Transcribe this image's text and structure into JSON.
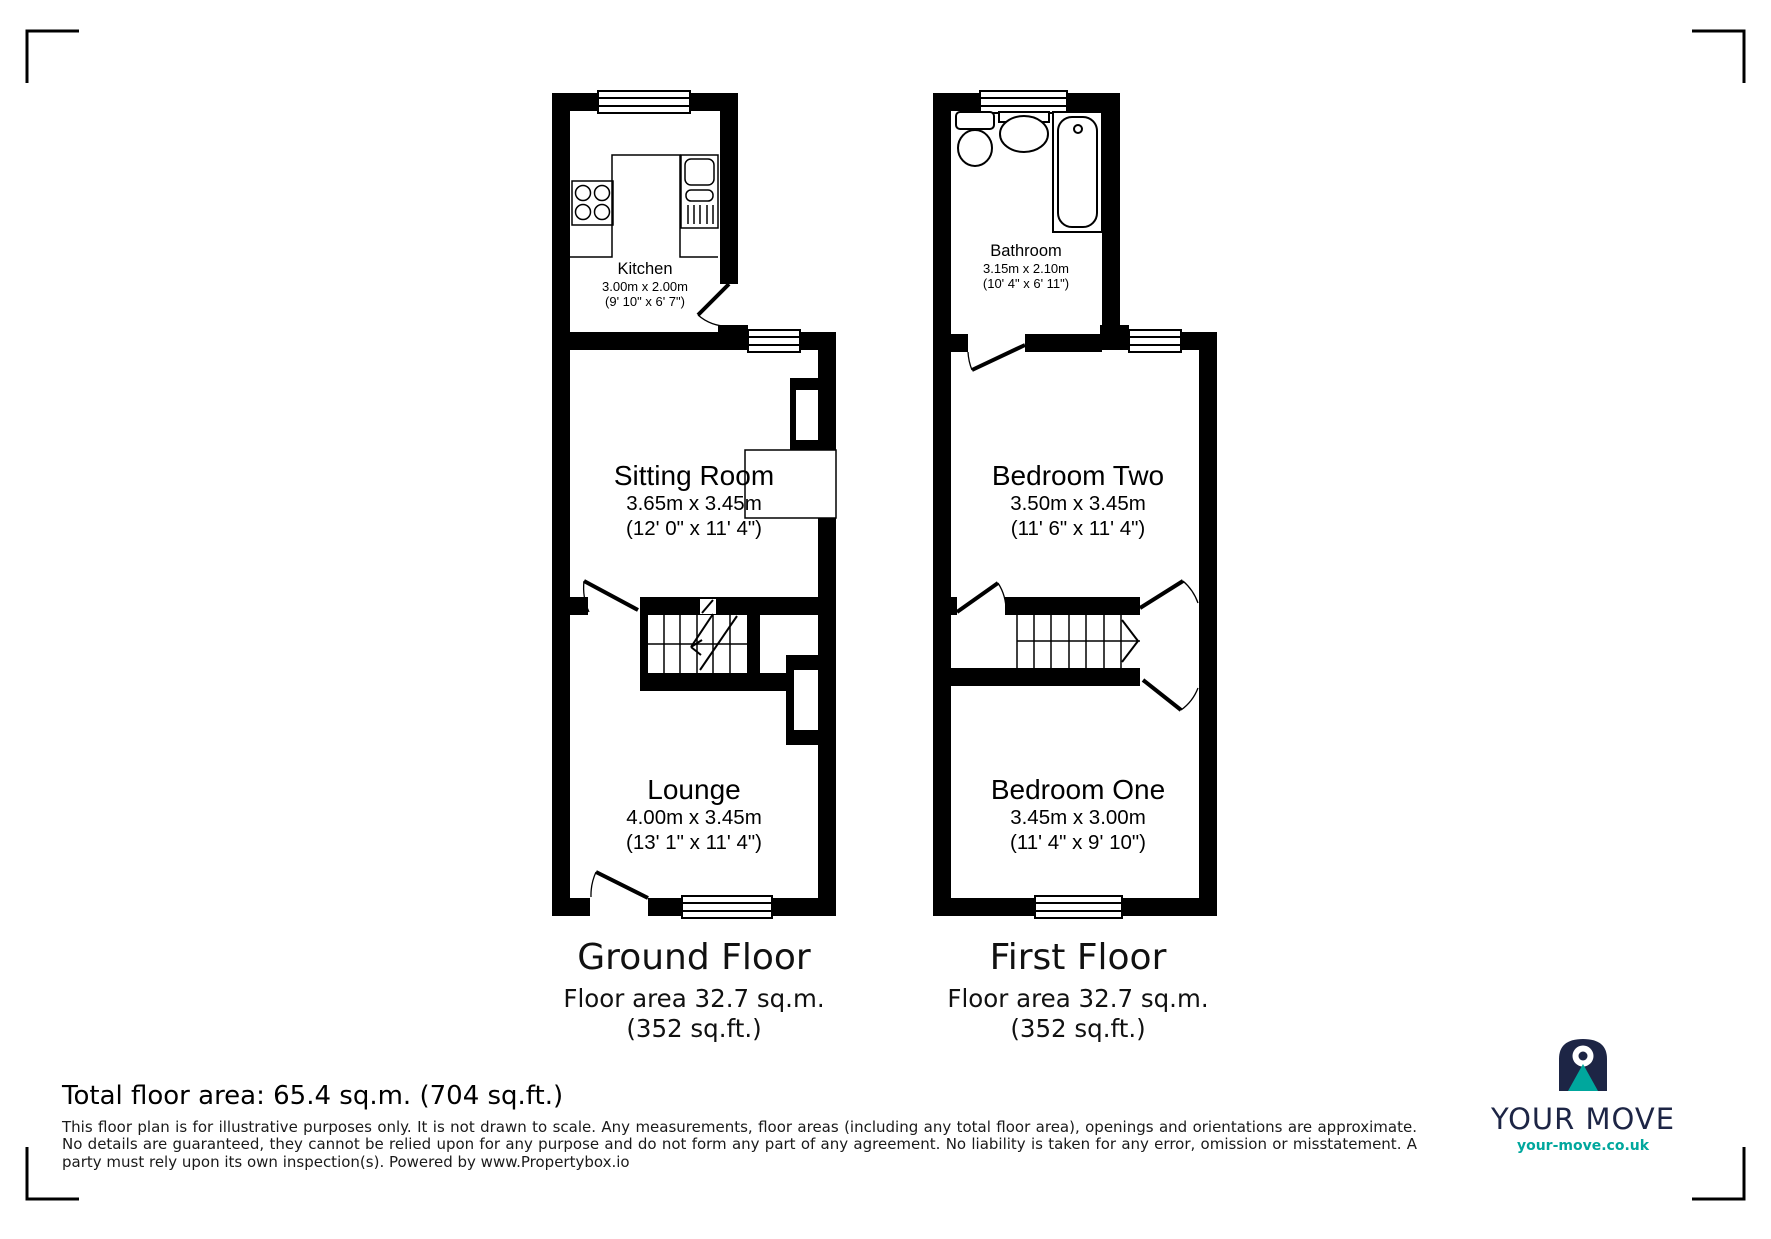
{
  "rooms": {
    "kitchen": {
      "name": "Kitchen",
      "metric": "3.00m x 2.00m",
      "imperial": "(9' 10\" x 6' 7\")"
    },
    "sitting_room": {
      "name": "Sitting Room",
      "metric": "3.65m x 3.45m",
      "imperial": "(12' 0\" x 11' 4\")"
    },
    "lounge": {
      "name": "Lounge",
      "metric": "4.00m x 3.45m",
      "imperial": "(13' 1\" x 11' 4\")"
    },
    "bathroom": {
      "name": "Bathroom",
      "metric": "3.15m x 2.10m",
      "imperial": "(10' 4\" x 6' 11\")"
    },
    "bedroom_two": {
      "name": "Bedroom Two",
      "metric": "3.50m x 3.45m",
      "imperial": "(11' 6\" x 11' 4\")"
    },
    "bedroom_one": {
      "name": "Bedroom One",
      "metric": "3.45m x 3.00m",
      "imperial": "(11' 4\" x 9' 10\")"
    }
  },
  "floors": {
    "ground": {
      "title": "Ground Floor",
      "area_caption": "Floor area 32.7 sq.m. (352 sq.ft.)"
    },
    "first": {
      "title": "First Floor",
      "area_caption": "Floor area 32.7 sq.m. (352 sq.ft.)"
    }
  },
  "footer": {
    "total_area": "Total floor area: 65.4 sq.m. (704 sq.ft.)",
    "disclaimer": "This floor plan is for illustrative purposes only. It is not drawn to scale. Any measurements, floor areas (including any total floor area), openings and orientations are approximate. No details are guaranteed, they cannot be relied upon for any purpose and do not form any part of any agreement. No liability is taken for any error, omission or misstatement. A party must rely upon its own inspection(s). Powered by www.Propertybox.io"
  },
  "branding": {
    "name": "YOUR MOVE",
    "url": "your-move.co.uk",
    "navy": "#1d2545",
    "teal": "#00a79d"
  }
}
